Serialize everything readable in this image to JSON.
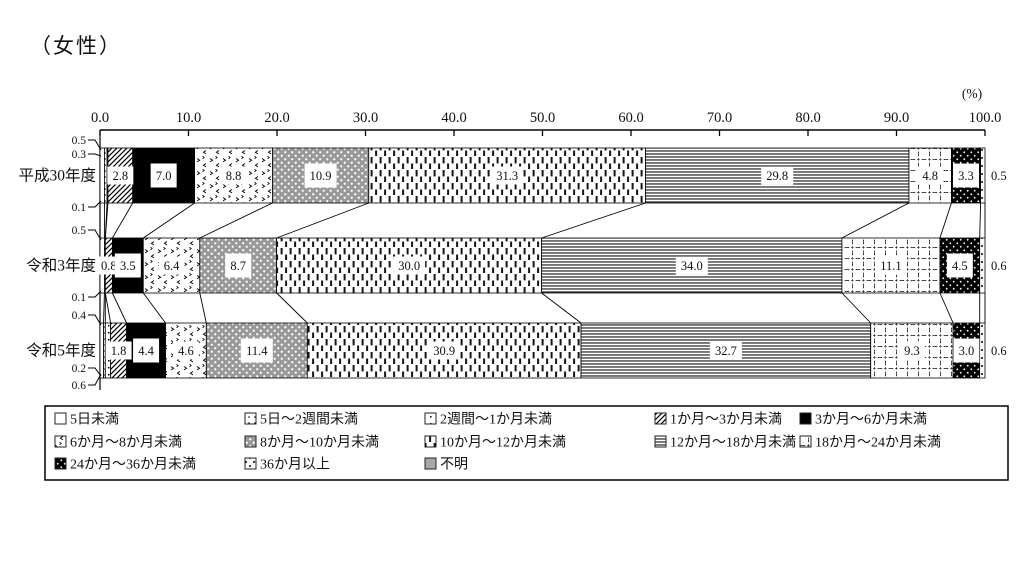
{
  "page": {
    "title": "（女性）"
  },
  "chart_data": {
    "type": "bar",
    "subtype": "horizontal-100pct-stacked",
    "title": "（女性）",
    "x_axis": {
      "unit": "(%)",
      "min": 0,
      "max": 100,
      "tick_labels": [
        "0.0",
        "10.0",
        "20.0",
        "30.0",
        "40.0",
        "50.0",
        "60.0",
        "70.0",
        "80.0",
        "90.0",
        "100.0"
      ]
    },
    "categories": [
      "平成30年度",
      "令和3年度",
      "令和5年度"
    ],
    "series": [
      {
        "name": "5日未満",
        "pattern": "plain-white",
        "values": [
          0.5,
          0.5,
          0.4
        ]
      },
      {
        "name": "5日～2週間未満",
        "pattern": "white-dot",
        "values": [
          0.3,
          0.1,
          0.2
        ]
      },
      {
        "name": "2週間～1か月未満",
        "pattern": "white-tick",
        "values": [
          0.1,
          0.0,
          0.6
        ]
      },
      {
        "name": "1か月～3か月未満",
        "pattern": "diagonal-hatch",
        "values": [
          2.8,
          0.8,
          1.8
        ]
      },
      {
        "name": "3か月～6か月未満",
        "pattern": "solid-black",
        "values": [
          7.0,
          3.5,
          4.4
        ]
      },
      {
        "name": "6か月～8か月未満",
        "pattern": "chevron-scatter",
        "values": [
          8.8,
          6.4,
          4.6
        ]
      },
      {
        "name": "8か月～10か月未満",
        "pattern": "gray-white-dots",
        "values": [
          10.9,
          8.7,
          11.4
        ]
      },
      {
        "name": "10か月～12か月未満",
        "pattern": "vertical-dashes",
        "values": [
          31.3,
          30.0,
          30.9
        ]
      },
      {
        "name": "12か月～18か月未満",
        "pattern": "horizontal-lines",
        "values": [
          29.8,
          34.0,
          32.7
        ]
      },
      {
        "name": "18か月～24か月未満",
        "pattern": "dashed-grid",
        "values": [
          4.8,
          11.1,
          9.3
        ]
      },
      {
        "name": "24か月～36か月未満",
        "pattern": "black-white-diamonds",
        "values": [
          3.3,
          4.5,
          3.0
        ]
      },
      {
        "name": "36か月以上",
        "pattern": "diamond-marks",
        "values": [
          0.5,
          0.6,
          0.6
        ]
      },
      {
        "name": "不明",
        "pattern": "solid-gray",
        "values": [
          0.0,
          0.0,
          0.0
        ]
      }
    ],
    "callout_placement": [
      [
        "top",
        "top",
        "bottom"
      ],
      [
        "top",
        "bottom",
        "none"
      ],
      [
        "top",
        "bottom",
        "bottom"
      ]
    ],
    "legend_position": "bottom",
    "grid": "off",
    "colors": {
      "ink": "#111111",
      "bar_stroke": "#000000",
      "unknown_gray": "#a8a8a8",
      "dot_gray": "#999999"
    }
  }
}
